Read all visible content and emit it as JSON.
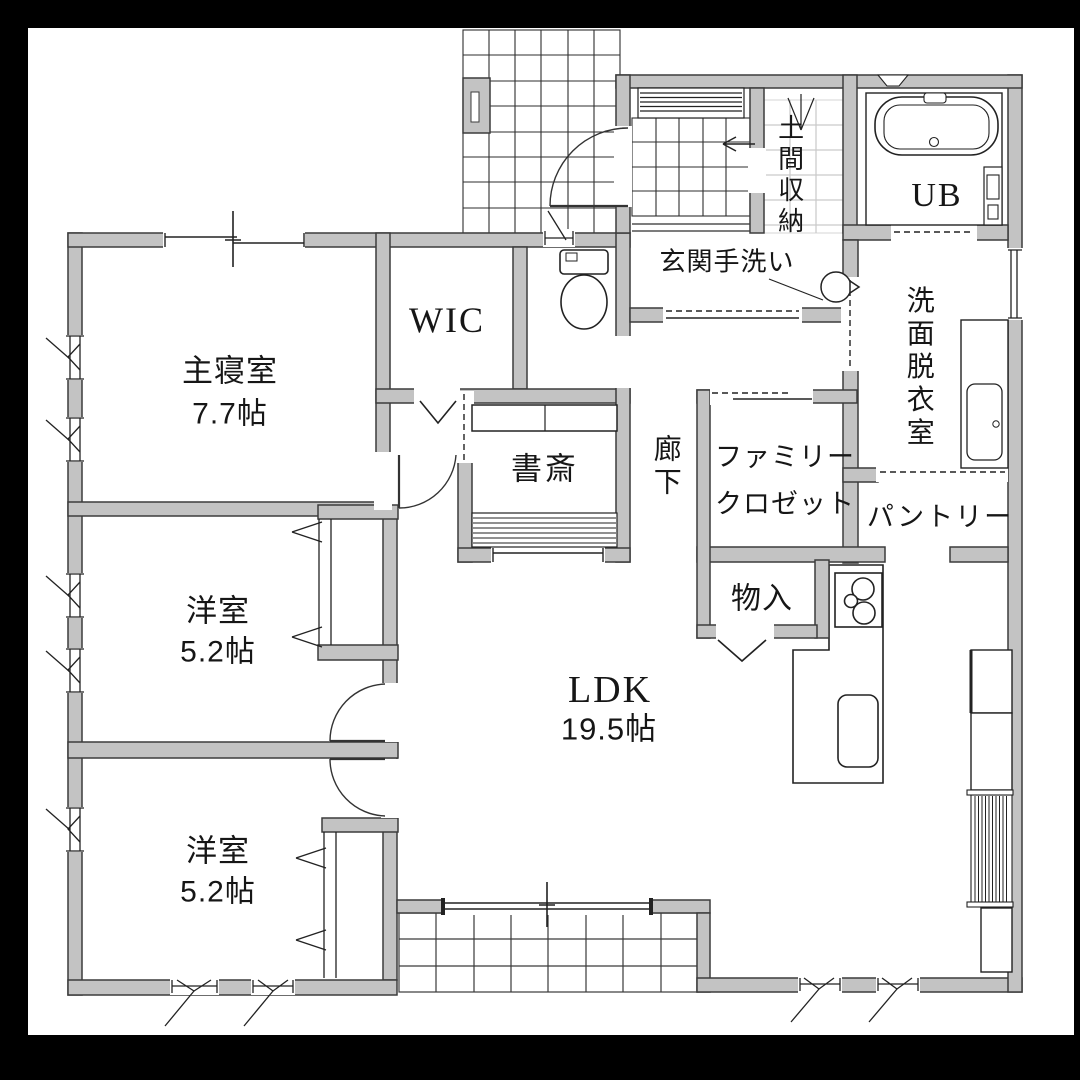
{
  "plan": {
    "title": "1F floor plan",
    "rooms": [
      {
        "id": "master-bedroom",
        "name": "主寝室",
        "size": "7.7帖"
      },
      {
        "id": "walk-in-closet",
        "name": "WIC"
      },
      {
        "id": "study",
        "name": "書斎"
      },
      {
        "id": "bedroom-a",
        "name": "洋室",
        "size": "5.2帖"
      },
      {
        "id": "bedroom-b",
        "name": "洋室",
        "size": "5.2帖"
      },
      {
        "id": "ldk",
        "name": "LDK",
        "size": "19.5帖"
      },
      {
        "id": "hallway",
        "name": "廊下"
      },
      {
        "id": "family-closet",
        "lines": [
          "ファミリー",
          "クロゼット"
        ]
      },
      {
        "id": "storage",
        "name": "物入"
      },
      {
        "id": "pantry",
        "name": "パントリー"
      },
      {
        "id": "washroom",
        "name": "洗面脱衣室"
      },
      {
        "id": "unit-bath",
        "name": "UB"
      },
      {
        "id": "entrance-storage",
        "name": "土間収納"
      },
      {
        "id": "entrance-handwash",
        "name": "玄関手洗い"
      }
    ],
    "colors": {
      "wall_fill": "#c3c3c3",
      "wall_outline": "#3c3c3c",
      "line": "#222222",
      "light_grid": "#cccccc",
      "frame": "#000000",
      "background": "#ffffff"
    }
  }
}
